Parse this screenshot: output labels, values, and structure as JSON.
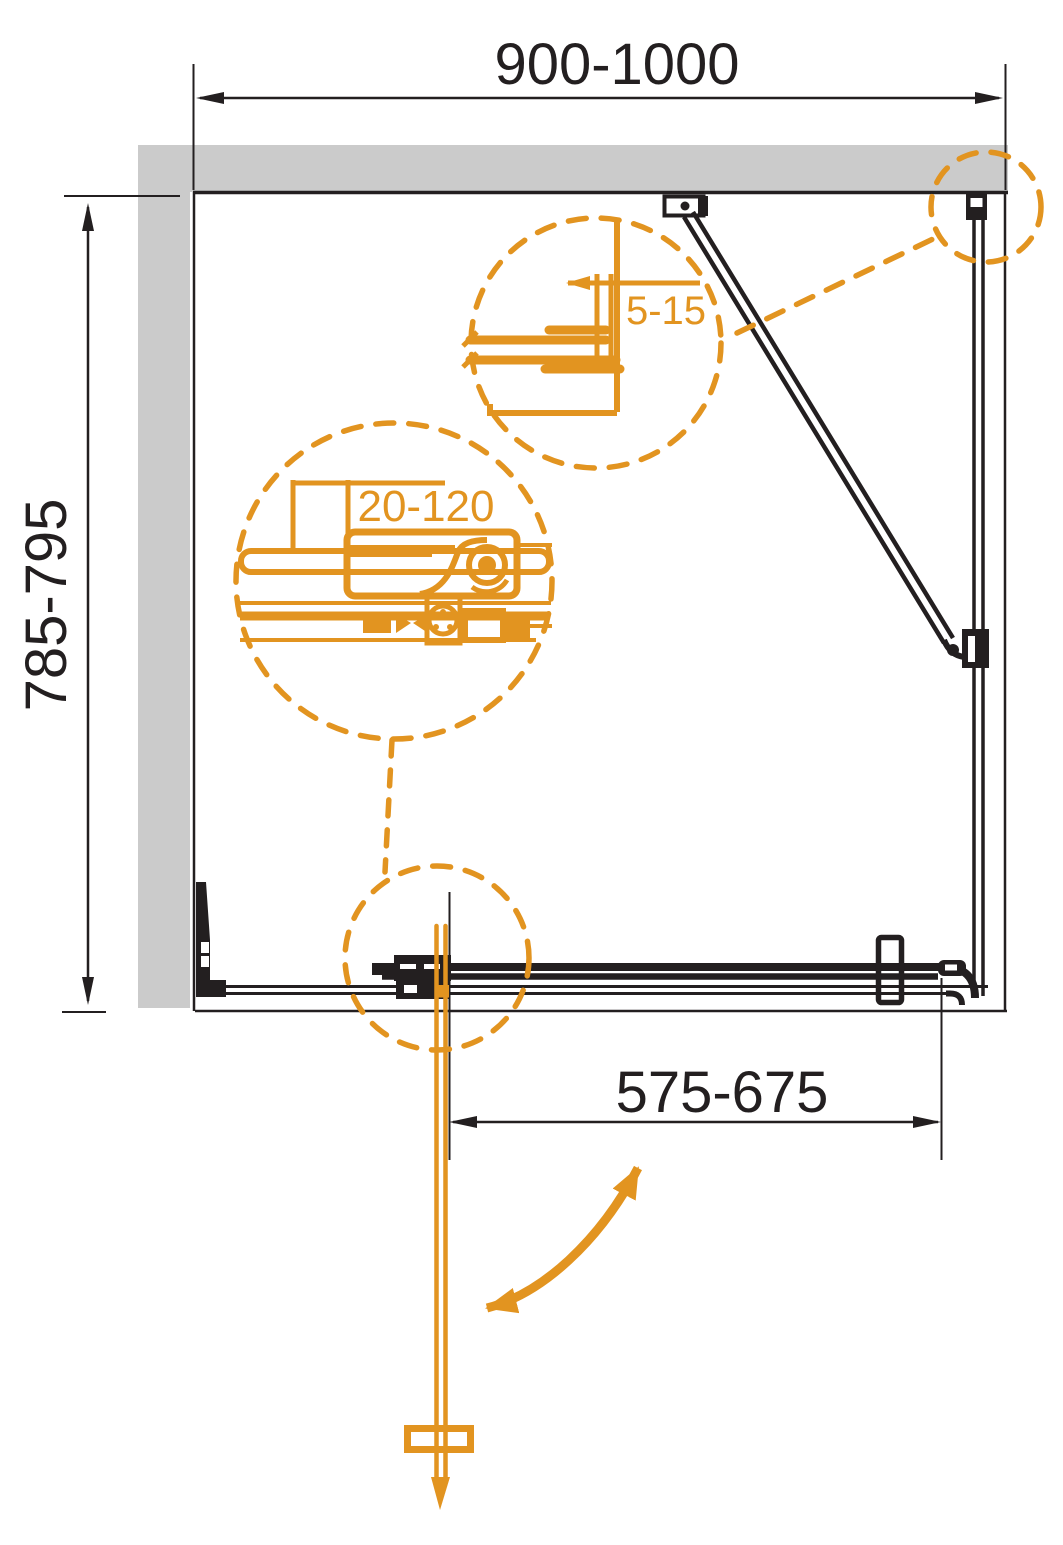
{
  "title": "Shower enclosure installation drawing (plan view)",
  "colors": {
    "accent_orange": "#E29420",
    "wall_gray": "#CBCBCB",
    "line_black": "#231F20",
    "background": "#FFFFFF"
  },
  "dimensions": {
    "enclosure_width_mm": "900-1000",
    "enclosure_depth_mm": "785-795",
    "door_opening_mm": "575-675",
    "wall_profile_adjustment_mm": "5-15",
    "slider_adjustment_mm": "20-120"
  },
  "icons": {
    "swing_arrow": "door-swing-direction-arrow",
    "detail_circles": "magnified-detail-callout"
  }
}
